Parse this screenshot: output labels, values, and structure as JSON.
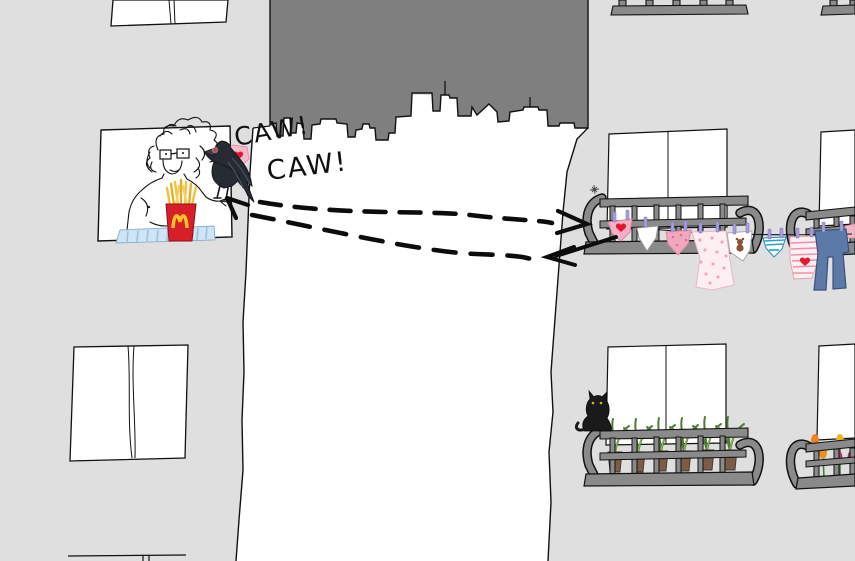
{
  "speech": {
    "caw_top": "CAW!",
    "caw_bottom": "CAW!"
  },
  "icons": {
    "crow": "black-crow-with-red-eye",
    "stolen_item": "pink-heart-panties",
    "cat": "black-cat",
    "fries": "mcdonalds-fries-box",
    "golden_arches": "M",
    "plants": "potted-palms",
    "flowers": "tulips",
    "laundry": [
      "heart-panties",
      "white-briefs",
      "floral-panties",
      "polka-dot-nightie",
      "teddy-print-cloth",
      "striped-underwear",
      "striped-shirt-with-heart",
      "blue-jeans"
    ],
    "arrows": [
      "dashed-flight-path-to-balcony",
      "dashed-return-path-to-window"
    ]
  },
  "colors": {
    "background": "#dfdfdf",
    "sky_block": "#7f7f7f",
    "middle_building": "#ffffff",
    "railing_gray": "#8a8a8a",
    "crow_black": "#262b33",
    "cat_black": "#1a1a1a",
    "fries_box_red": "#d61f26",
    "arches_yellow": "#ffc425",
    "fries_yellow": "#f2c23c",
    "panties_pink": "#f6afc4",
    "heart_red": "#e01830",
    "jeans_blue": "#5c7aa8",
    "stripe_blue": "#28a0d4",
    "clothespin_lavender": "#a8a0da",
    "plant_green": "#4e7c38",
    "blanket_blue": "#cfe4f4",
    "ink_black": "#111111"
  }
}
